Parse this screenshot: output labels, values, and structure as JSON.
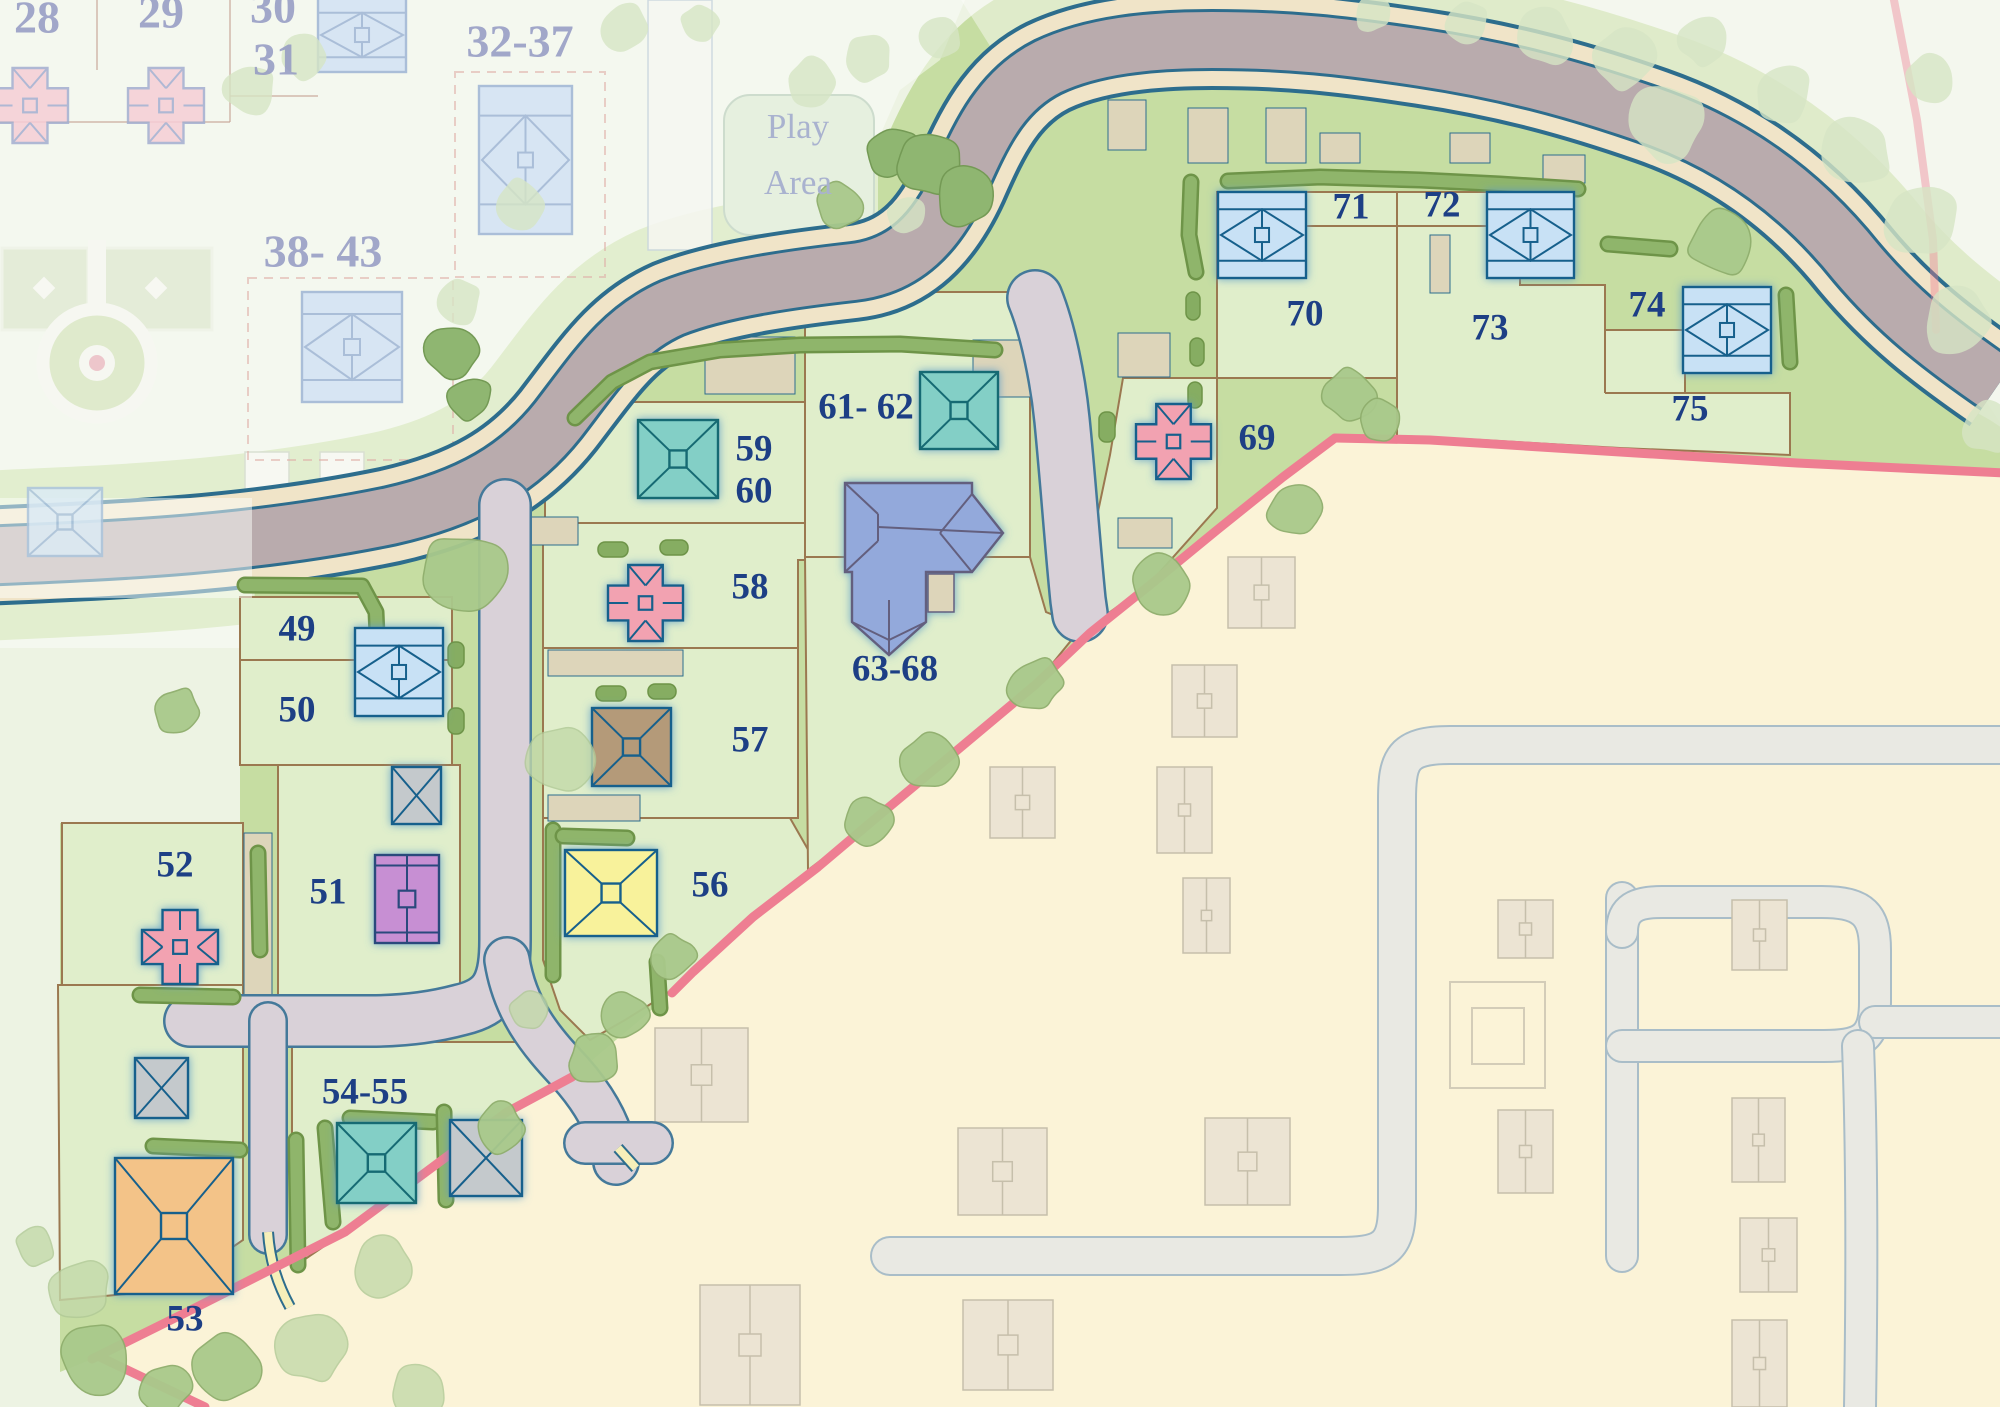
{
  "title": "Residential development site plan",
  "play_area": {
    "line1": "Play",
    "line2": "Area"
  },
  "active_plot_labels": [
    {
      "id": "49",
      "text": "49"
    },
    {
      "id": "50",
      "text": "50"
    },
    {
      "id": "51",
      "text": "51"
    },
    {
      "id": "52",
      "text": "52"
    },
    {
      "id": "53",
      "text": "53"
    },
    {
      "id": "54-55",
      "text": "54-55"
    },
    {
      "id": "56",
      "text": "56"
    },
    {
      "id": "57",
      "text": "57"
    },
    {
      "id": "58",
      "text": "58"
    },
    {
      "id": "59",
      "text": "59"
    },
    {
      "id": "60",
      "text": "60"
    },
    {
      "id": "61-62",
      "text": "61- 62"
    },
    {
      "id": "63-68",
      "text": "63-68"
    },
    {
      "id": "69",
      "text": "69"
    },
    {
      "id": "70",
      "text": "70"
    },
    {
      "id": "71",
      "text": "71"
    },
    {
      "id": "72",
      "text": "72"
    },
    {
      "id": "73",
      "text": "73"
    },
    {
      "id": "74",
      "text": "74"
    },
    {
      "id": "75",
      "text": "75"
    }
  ],
  "faded_plot_labels": [
    {
      "id": "28",
      "text": "28"
    },
    {
      "id": "29",
      "text": "29"
    },
    {
      "id": "30",
      "text": "30"
    },
    {
      "id": "31",
      "text": "31"
    },
    {
      "id": "32-37",
      "text": "32-37"
    },
    {
      "id": "38-43",
      "text": "38- 43"
    }
  ],
  "houses": [
    {
      "plot": "49-50",
      "type": "hiprect",
      "color": "blue",
      "x": 355,
      "y": 628,
      "w": 88,
      "h": 88
    },
    {
      "plot": "70-71",
      "type": "hiprect",
      "color": "blue",
      "x": 1218,
      "y": 192,
      "w": 88,
      "h": 86
    },
    {
      "plot": "72-73",
      "type": "hiprect",
      "color": "blue",
      "x": 1487,
      "y": 192,
      "w": 87,
      "h": 86
    },
    {
      "plot": "74-75",
      "type": "hiprect",
      "color": "blue",
      "x": 1683,
      "y": 287,
      "w": 88,
      "h": 86
    },
    {
      "plot": "59-60",
      "type": "pyramid",
      "color": "teal",
      "x": 638,
      "y": 420,
      "w": 80,
      "h": 78
    },
    {
      "plot": "61-62",
      "type": "pyramid",
      "color": "teal",
      "x": 920,
      "y": 372,
      "w": 78,
      "h": 77
    },
    {
      "plot": "54-55",
      "type": "pyramid",
      "color": "teal",
      "x": 337,
      "y": 1123,
      "w": 79,
      "h": 80
    },
    {
      "plot": "57",
      "type": "pyramid",
      "color": "brown",
      "x": 592,
      "y": 708,
      "w": 79,
      "h": 78
    },
    {
      "plot": "56",
      "type": "pyramid",
      "color": "yellow",
      "x": 565,
      "y": 850,
      "w": 92,
      "h": 86
    },
    {
      "plot": "53",
      "type": "pyramid",
      "color": "orange",
      "x": 115,
      "y": 1158,
      "w": 118,
      "h": 136
    },
    {
      "plot": "52",
      "type": "cross",
      "color": "pink",
      "orient": "h",
      "x": 142,
      "y": 910,
      "w": 76,
      "h": 74
    },
    {
      "plot": "58",
      "type": "cross",
      "color": "pink",
      "orient": "v",
      "x": 608,
      "y": 565,
      "w": 75,
      "h": 76
    },
    {
      "plot": "69",
      "type": "cross",
      "color": "pink",
      "orient": "v",
      "x": 1136,
      "y": 404,
      "w": 75,
      "h": 75
    },
    {
      "plot": "51",
      "type": "duplex",
      "color": "purple",
      "x": 375,
      "y": 855,
      "w": 64,
      "h": 88
    },
    {
      "plot": "63-68",
      "type": "bighouse",
      "color": "periwinkle",
      "x": 845,
      "y": 483,
      "w": 160,
      "h": 172
    },
    {
      "plot": "garage-50",
      "type": "garage",
      "color": "grey",
      "x": 392,
      "y": 767,
      "w": 49,
      "h": 57
    },
    {
      "plot": "garage-52",
      "type": "garage",
      "color": "grey",
      "x": 135,
      "y": 1058,
      "w": 53,
      "h": 60
    },
    {
      "plot": "garage-54",
      "type": "garage",
      "color": "grey",
      "x": 450,
      "y": 1120,
      "w": 72,
      "h": 76
    }
  ],
  "faded_houses": [
    {
      "type": "cross",
      "color": "fadedpink",
      "orient": "v",
      "x": -8,
      "y": 68,
      "w": 76,
      "h": 75
    },
    {
      "type": "cross",
      "color": "fadedpink",
      "orient": "v",
      "x": 128,
      "y": 68,
      "w": 76,
      "h": 75
    },
    {
      "type": "hiprect",
      "color": "fadedblue",
      "x": 318,
      "y": -2,
      "w": 88,
      "h": 74
    },
    {
      "type": "hiprect",
      "color": "fadedblue",
      "x": 479,
      "y": 86,
      "w": 93,
      "h": 148
    },
    {
      "type": "hiprect",
      "color": "fadedblue",
      "x": 302,
      "y": 292,
      "w": 100,
      "h": 110
    },
    {
      "type": "pyramid",
      "color": "fadedblue2",
      "x": 28,
      "y": 488,
      "w": 74,
      "h": 68
    }
  ],
  "future_houses": [
    [
      1228,
      557,
      67,
      71
    ],
    [
      1172,
      665,
      65,
      72
    ],
    [
      990,
      767,
      65,
      71
    ],
    [
      1157,
      767,
      55,
      86
    ],
    [
      1183,
      878,
      47,
      75
    ],
    [
      1498,
      900,
      55,
      58
    ],
    [
      1732,
      900,
      55,
      70
    ],
    [
      1498,
      1110,
      55,
      83
    ],
    [
      1732,
      1098,
      53,
      84
    ],
    [
      1740,
      1218,
      57,
      74
    ],
    [
      1732,
      1320,
      55,
      87
    ],
    [
      655,
      1028,
      93,
      94
    ],
    [
      700,
      1285,
      100,
      120
    ],
    [
      958,
      1128,
      89,
      87
    ],
    [
      1205,
      1118,
      85,
      87
    ],
    [
      963,
      1300,
      90,
      90
    ]
  ],
  "colors": {
    "base": "#edf3e3",
    "lawn": "#c6dda2",
    "parcel": "#e0eecb",
    "parcel_line": "#9b7850",
    "cream_phase": "#fbf3d7",
    "road": "#b9abad",
    "road_verge": "#f0e4c8",
    "road_edge": "#2d6d8d",
    "drive": "#d9d1d8",
    "drive_edge": "#44799a",
    "future_road": "#e9e9e3",
    "future_road_edge": "#a9bdc8",
    "footpath": "#f6efb9",
    "hedge_dark": "#6e9448",
    "hedge_light": "#8fb56b",
    "boundary_pink": "#ee7e92",
    "active_label": "#1d3f85",
    "faded_label": "#9399c3",
    "play_label": "#a9b2cf",
    "house_blue": "#c8e1f5",
    "house_teal": "#83cfc6",
    "house_pink": "#f2a2b1",
    "house_yellow": "#f8f29b",
    "house_orange": "#f3c388",
    "house_purple": "#c78fd3",
    "house_brown": "#b49a79",
    "house_grey": "#c4c9cc",
    "house_periwinkle": "#93a9db",
    "house_outline": "#19618c",
    "future_house": "#ece4d3",
    "future_house_line": "#c6bfab"
  }
}
